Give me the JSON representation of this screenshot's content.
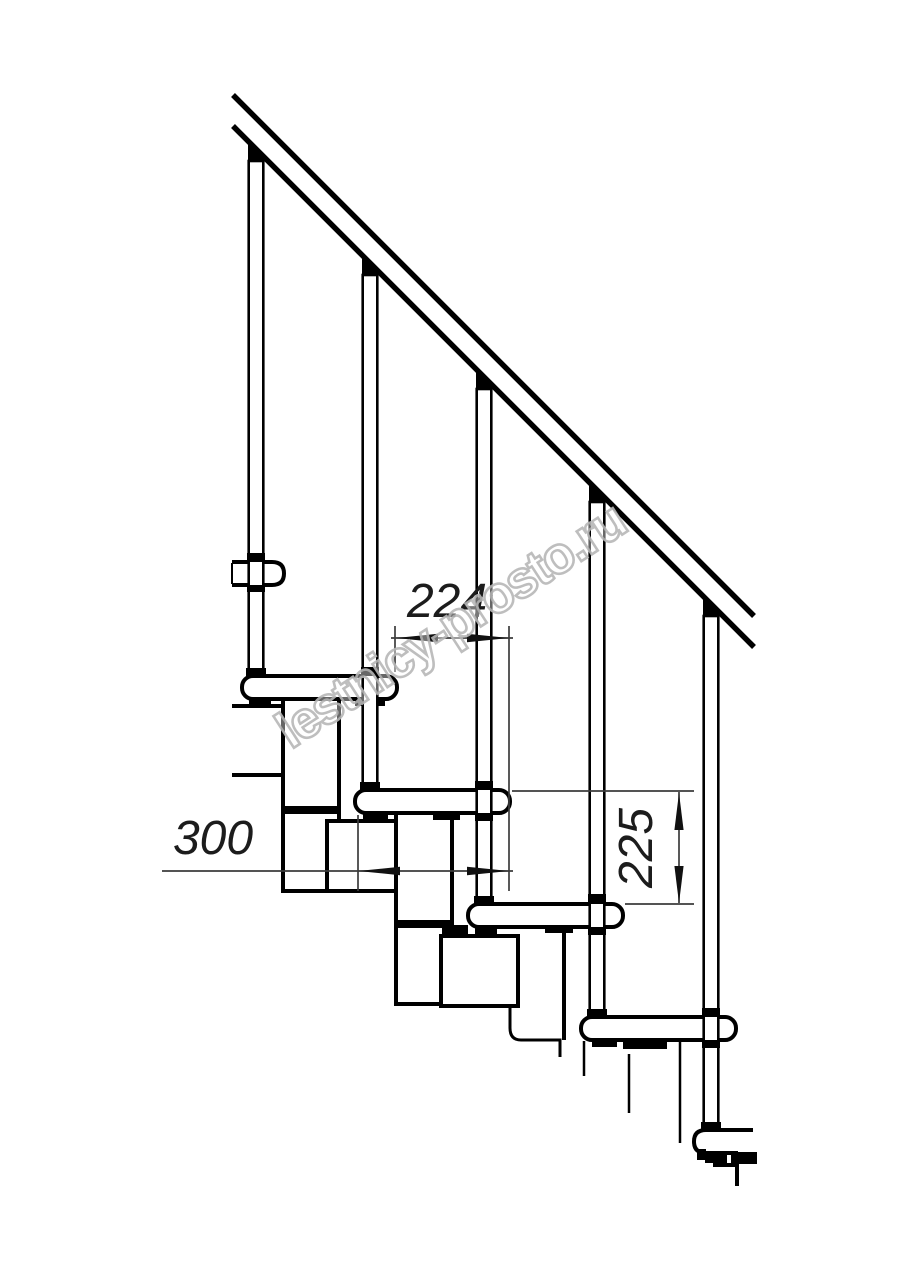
{
  "page": {
    "background": "#ffffff"
  },
  "drawing": {
    "watermark": {
      "text": "lestnicy-prosto.ru",
      "color": "#b8b8b8",
      "angle_deg": -33
    },
    "dimensions": [
      {
        "id": "step-run",
        "value": "224",
        "orientation": "horizontal"
      },
      {
        "id": "tread-depth",
        "value": "300",
        "orientation": "horizontal"
      },
      {
        "id": "step-rise",
        "value": "225",
        "orientation": "vertical"
      }
    ],
    "colors": {
      "line": "#000000",
      "dim_line": "#3c3c3c",
      "background": "#ffffff"
    }
  }
}
